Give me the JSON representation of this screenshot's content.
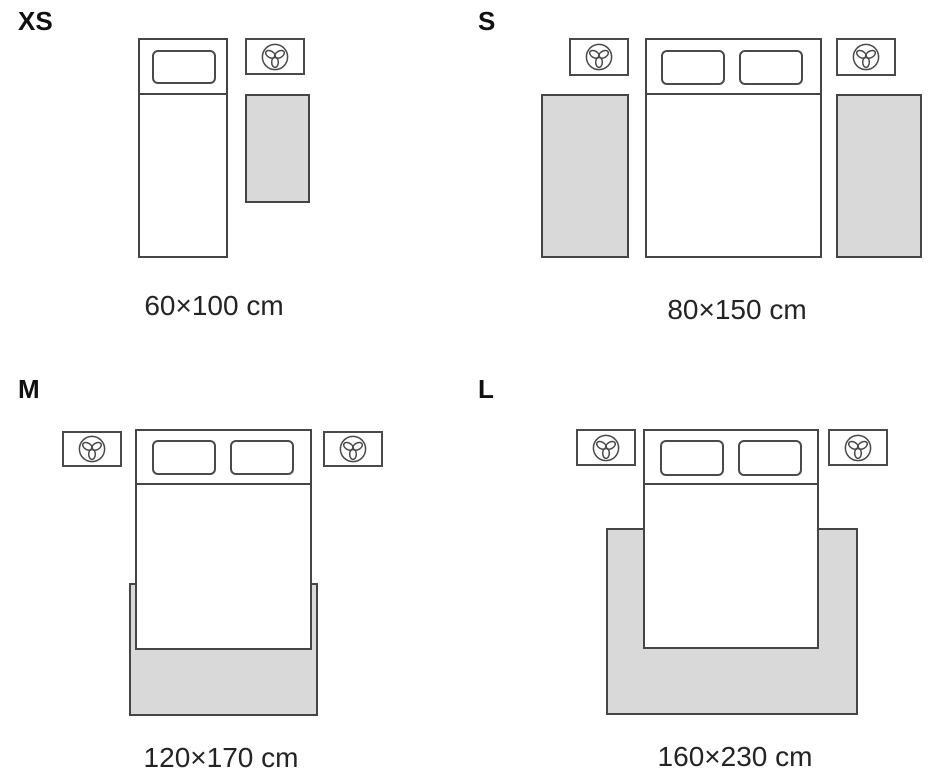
{
  "colors": {
    "background": "#ffffff",
    "outline": "#454545",
    "rug_fill": "#d9d9d9",
    "label_text": "#101010",
    "caption_text": "#242424"
  },
  "icons": {
    "nightstand_icon": "plant-icon"
  },
  "panels": [
    {
      "label": "XS",
      "size": "60×100 cm",
      "bed": "single",
      "pillows": 1,
      "nightstands": 1,
      "rugs": 1,
      "rug_placement": "beside bed"
    },
    {
      "label": "S",
      "size": "80×150 cm",
      "bed": "double",
      "pillows": 2,
      "nightstands": 2,
      "rugs": 2,
      "rug_placement": "both sides of bed"
    },
    {
      "label": "M",
      "size": "120×170 cm",
      "bed": "double",
      "pillows": 2,
      "nightstands": 2,
      "rugs": 1,
      "rug_placement": "under foot of bed"
    },
    {
      "label": "L",
      "size": "160×230 cm",
      "bed": "double",
      "pillows": 2,
      "nightstands": 2,
      "rugs": 1,
      "rug_placement": "under lower two-thirds of bed"
    }
  ]
}
